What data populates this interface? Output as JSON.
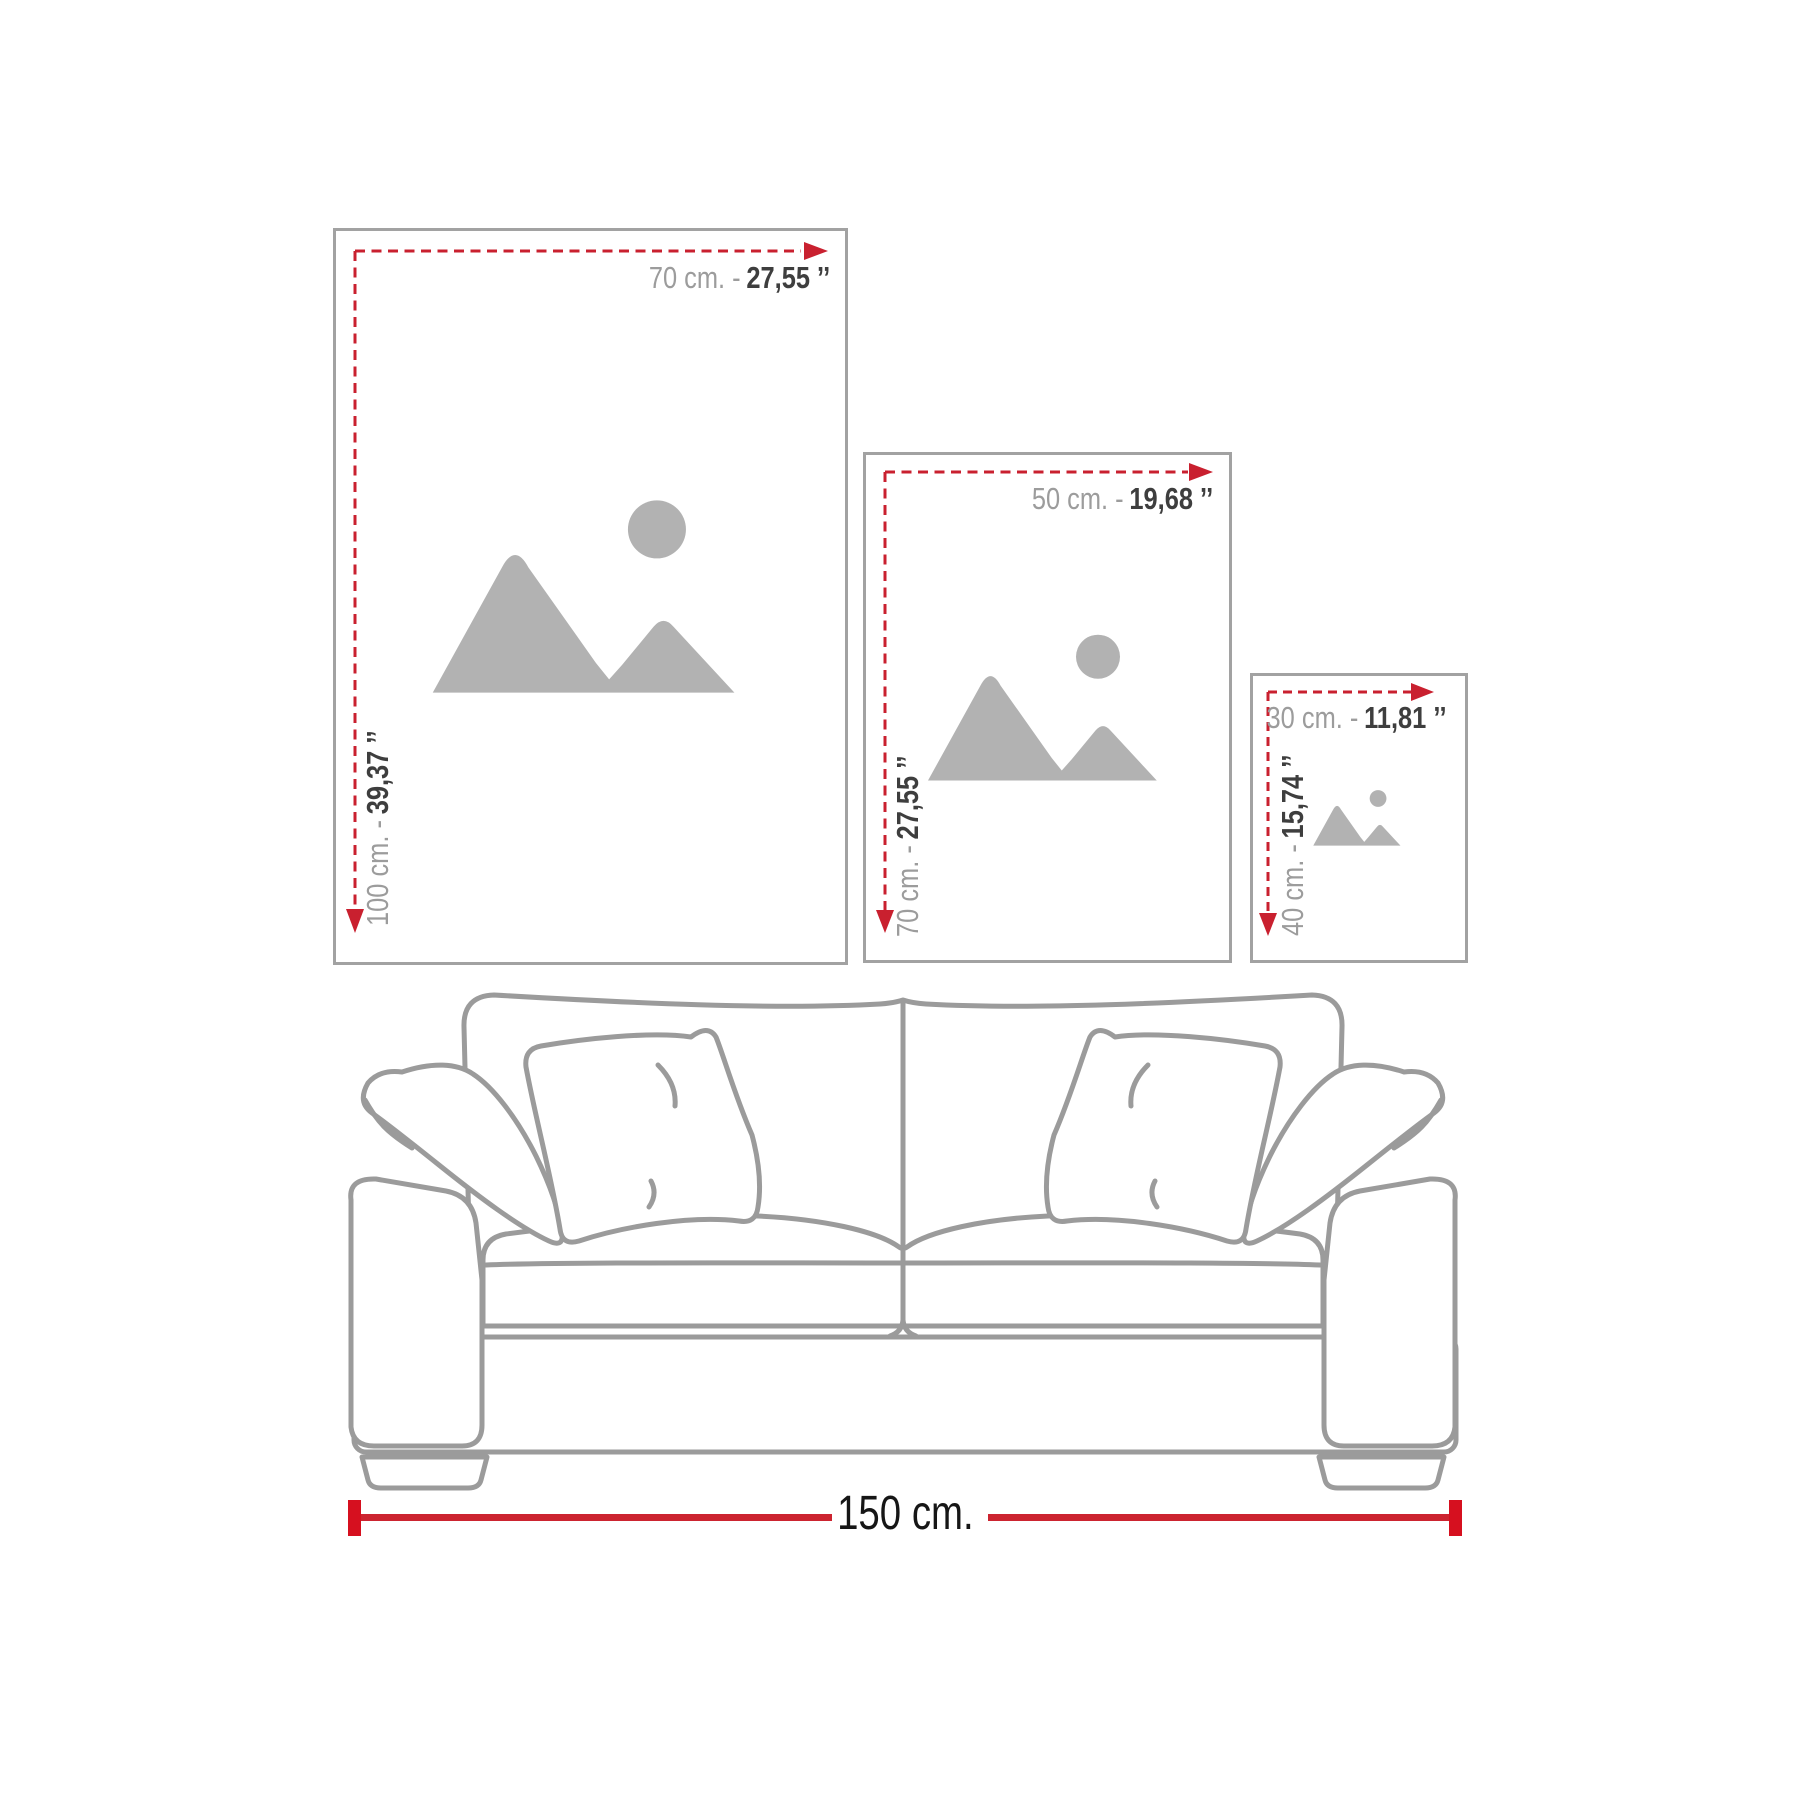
{
  "colors": {
    "red_dash": "#c9202f",
    "red_solid": "#d6101f",
    "frame_border": "#a2a2a2",
    "sofa_line": "#9b9b9b",
    "icon_gray": "#b2b2b2",
    "label_gray": "#9c9c9c",
    "label_dark": "#3e3e3e",
    "label_black": "#161616"
  },
  "frames": [
    {
      "id": "poster-70x100",
      "width_cm": "70 cm. -",
      "width_in": "27,55 ’’",
      "height_cm": "100 cm. -",
      "height_in": "39,37 ’’"
    },
    {
      "id": "poster-50x70",
      "width_cm": "50 cm. -",
      "width_in": "19,68 ’’",
      "height_cm": "70 cm. -",
      "height_in": "27,55 ’’"
    },
    {
      "id": "poster-30x40",
      "width_cm": "30 cm. -",
      "width_in": "11,81 ’’",
      "height_cm": "40 cm. -",
      "height_in": "15,74 ’’"
    }
  ],
  "sofa": {
    "width_label": "150 cm."
  }
}
